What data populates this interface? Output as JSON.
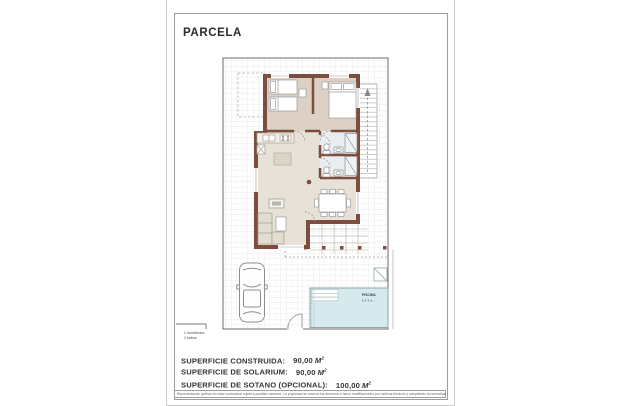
{
  "document": {
    "title": "PARCELA",
    "legend": {
      "line1": "2 dormitorios.",
      "line2": "2 baños"
    },
    "areas": {
      "rows": [
        {
          "label": "SUPERFICIE CONSTRUIDA:",
          "value": "90,00",
          "unit": "M",
          "sup": "2"
        },
        {
          "label": "SUPERFICIE DE SOLARIUM:",
          "value": "90,00",
          "unit": "M",
          "sup": "2"
        },
        {
          "label": "SUPERFICIE DE SOTANO (OPCIONAL):",
          "value": "100,00",
          "unit": "M",
          "sup": "2"
        }
      ]
    },
    "plan": {
      "pool_label": "PISCINA",
      "pool_size": "6 X 3 m"
    },
    "disclaimer": "Representación gráfica sin valor contractual sujeta a posibles cambios. La propiedad se reserva los derechos a hacer modificaciones por motivos técnicos y cumpliendo la normativa vigente.",
    "colors": {
      "wall": "#7d4e3d",
      "pool_water": "#d6e9ec",
      "floor_living": "#e7e1d7",
      "floor_bedroom": "#ddd1c5",
      "floor_bath": "#e9edef",
      "grid": "#dbdbdb"
    }
  }
}
